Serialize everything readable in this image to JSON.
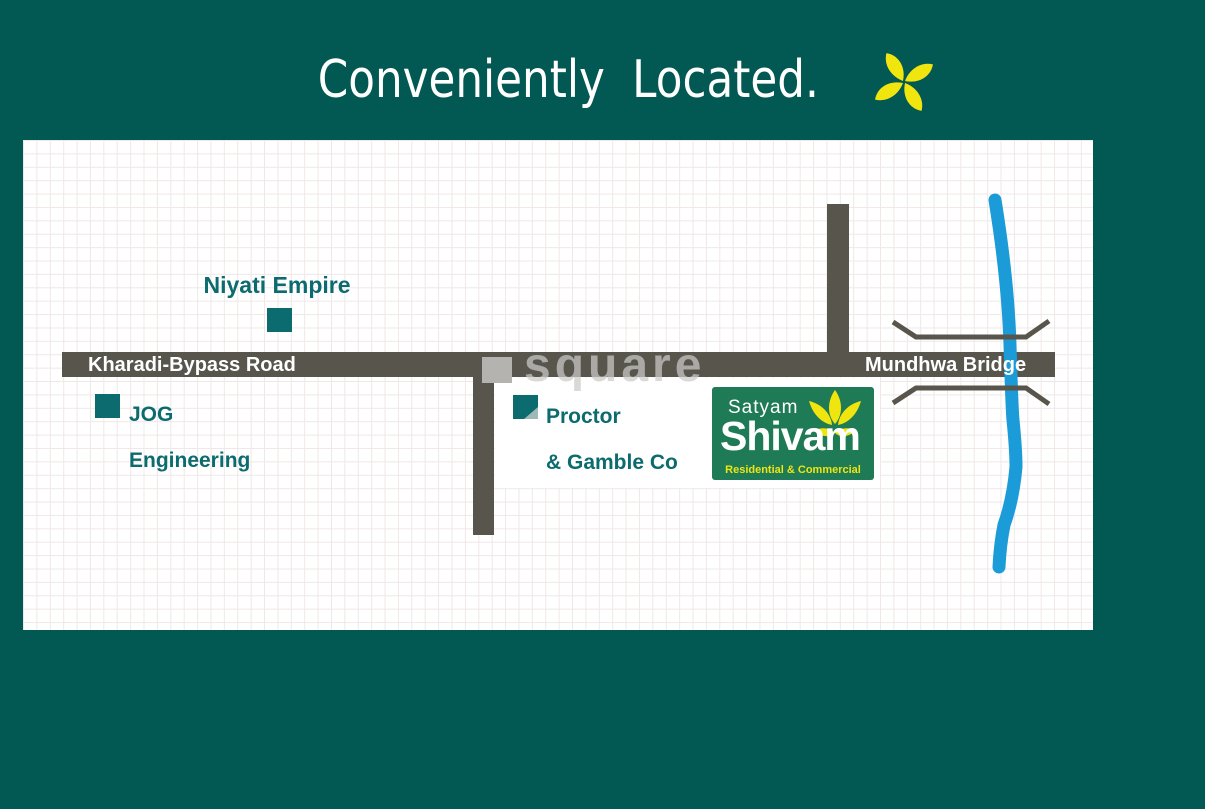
{
  "title": {
    "text": "Conveniently Located."
  },
  "map": {
    "roads": {
      "horizontal_left_label": "Kharadi-Bypass Road",
      "horizontal_right_label": "Mundhwa Bridge"
    },
    "landmarks": [
      {
        "id": "niyati",
        "label": "Niyati Empire"
      },
      {
        "id": "jog",
        "line1": "JOG",
        "line2": "Engineering"
      },
      {
        "id": "proctor",
        "line1": "Proctor",
        "line2": "& Gamble Co"
      }
    ],
    "watermark": {
      "text": "square"
    },
    "logo": {
      "line1": "Satyam",
      "line2": "Shivam",
      "tagline": "Residential & Commercial"
    }
  },
  "colors": {
    "background_teal": "#025852",
    "road_gray": "#58554D",
    "landmark_teal": "#0B6B6E",
    "river_blue": "#1B9CD8",
    "logo_green": "#1E7B55",
    "brand_yellow": "#F0E50F",
    "watermark_gray": "#B5B3B0",
    "map_white": "#FFFFFF"
  }
}
